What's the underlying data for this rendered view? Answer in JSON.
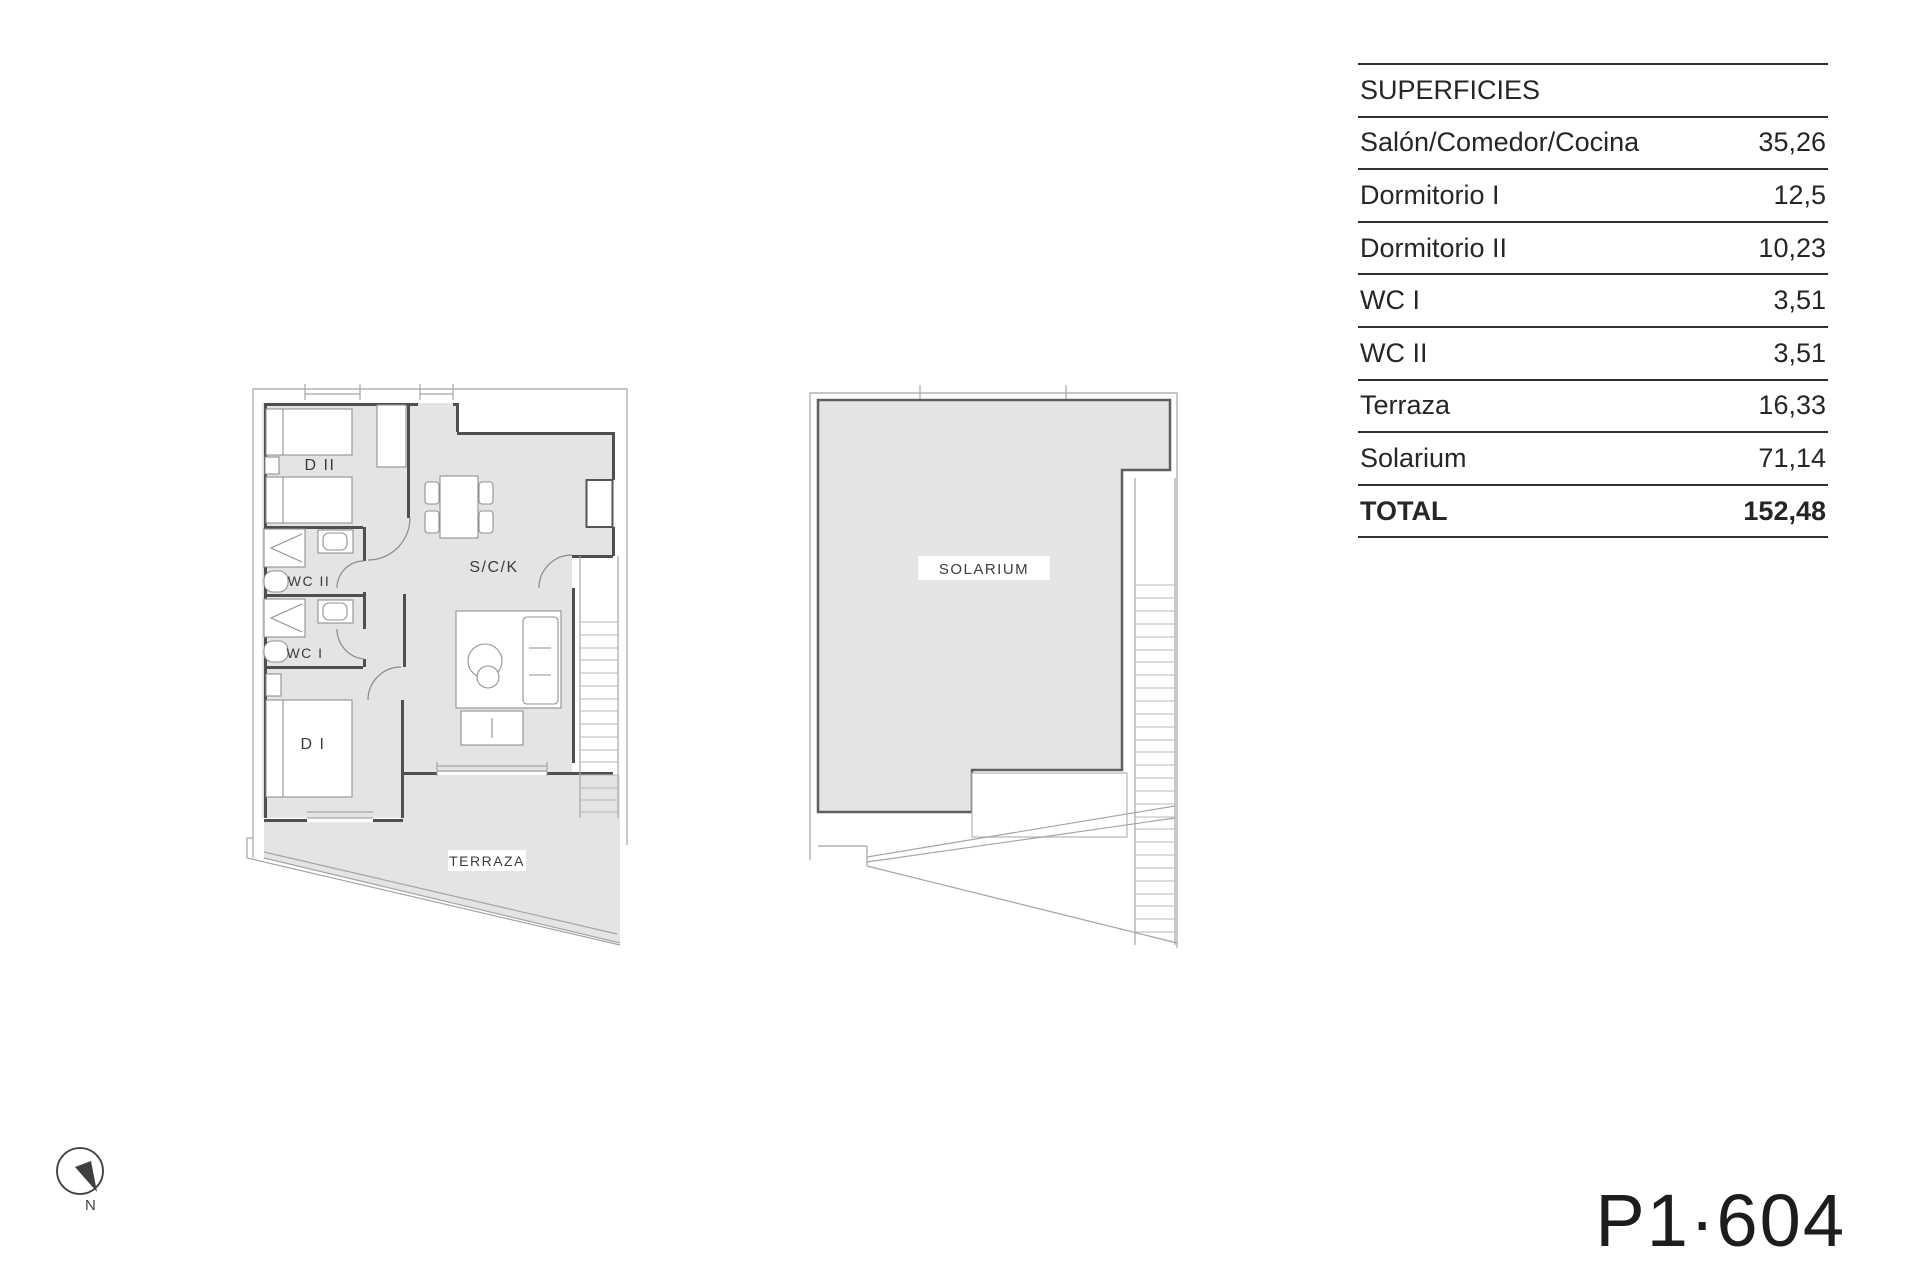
{
  "colors": {
    "background": "#ffffff",
    "floor_fill": "#e3e4e3",
    "wall": "#4f4f4f",
    "thin_line": "#a5a5a5",
    "table_line": "#2f2f2f",
    "text": "#262626"
  },
  "apartment_plan": {
    "bedroom2_label": "D II",
    "wc2_label": "WC II",
    "wc1_label": "WC I",
    "bedroom1_label": "D I",
    "living_label": "S/C/K",
    "terrace_label": "TERRAZA"
  },
  "solarium_plan": {
    "label": "SOLARIUM"
  },
  "compass": {
    "north_label": "N"
  },
  "surfaces_table": {
    "title": "SUPERFICIES",
    "rows": [
      {
        "label": "Salón/Comedor/Cocina",
        "value": "35,26"
      },
      {
        "label": "Dormitorio I",
        "value": "12,5"
      },
      {
        "label": "Dormitorio II",
        "value": "10,23"
      },
      {
        "label": "WC I",
        "value": "3,51"
      },
      {
        "label": "WC II",
        "value": "3,51"
      },
      {
        "label": "Terraza",
        "value": "16,33"
      },
      {
        "label": "Solarium",
        "value": "71,14"
      }
    ],
    "total_label": "TOTAL",
    "total_value": "152,48"
  },
  "plan_code": "P1·604"
}
